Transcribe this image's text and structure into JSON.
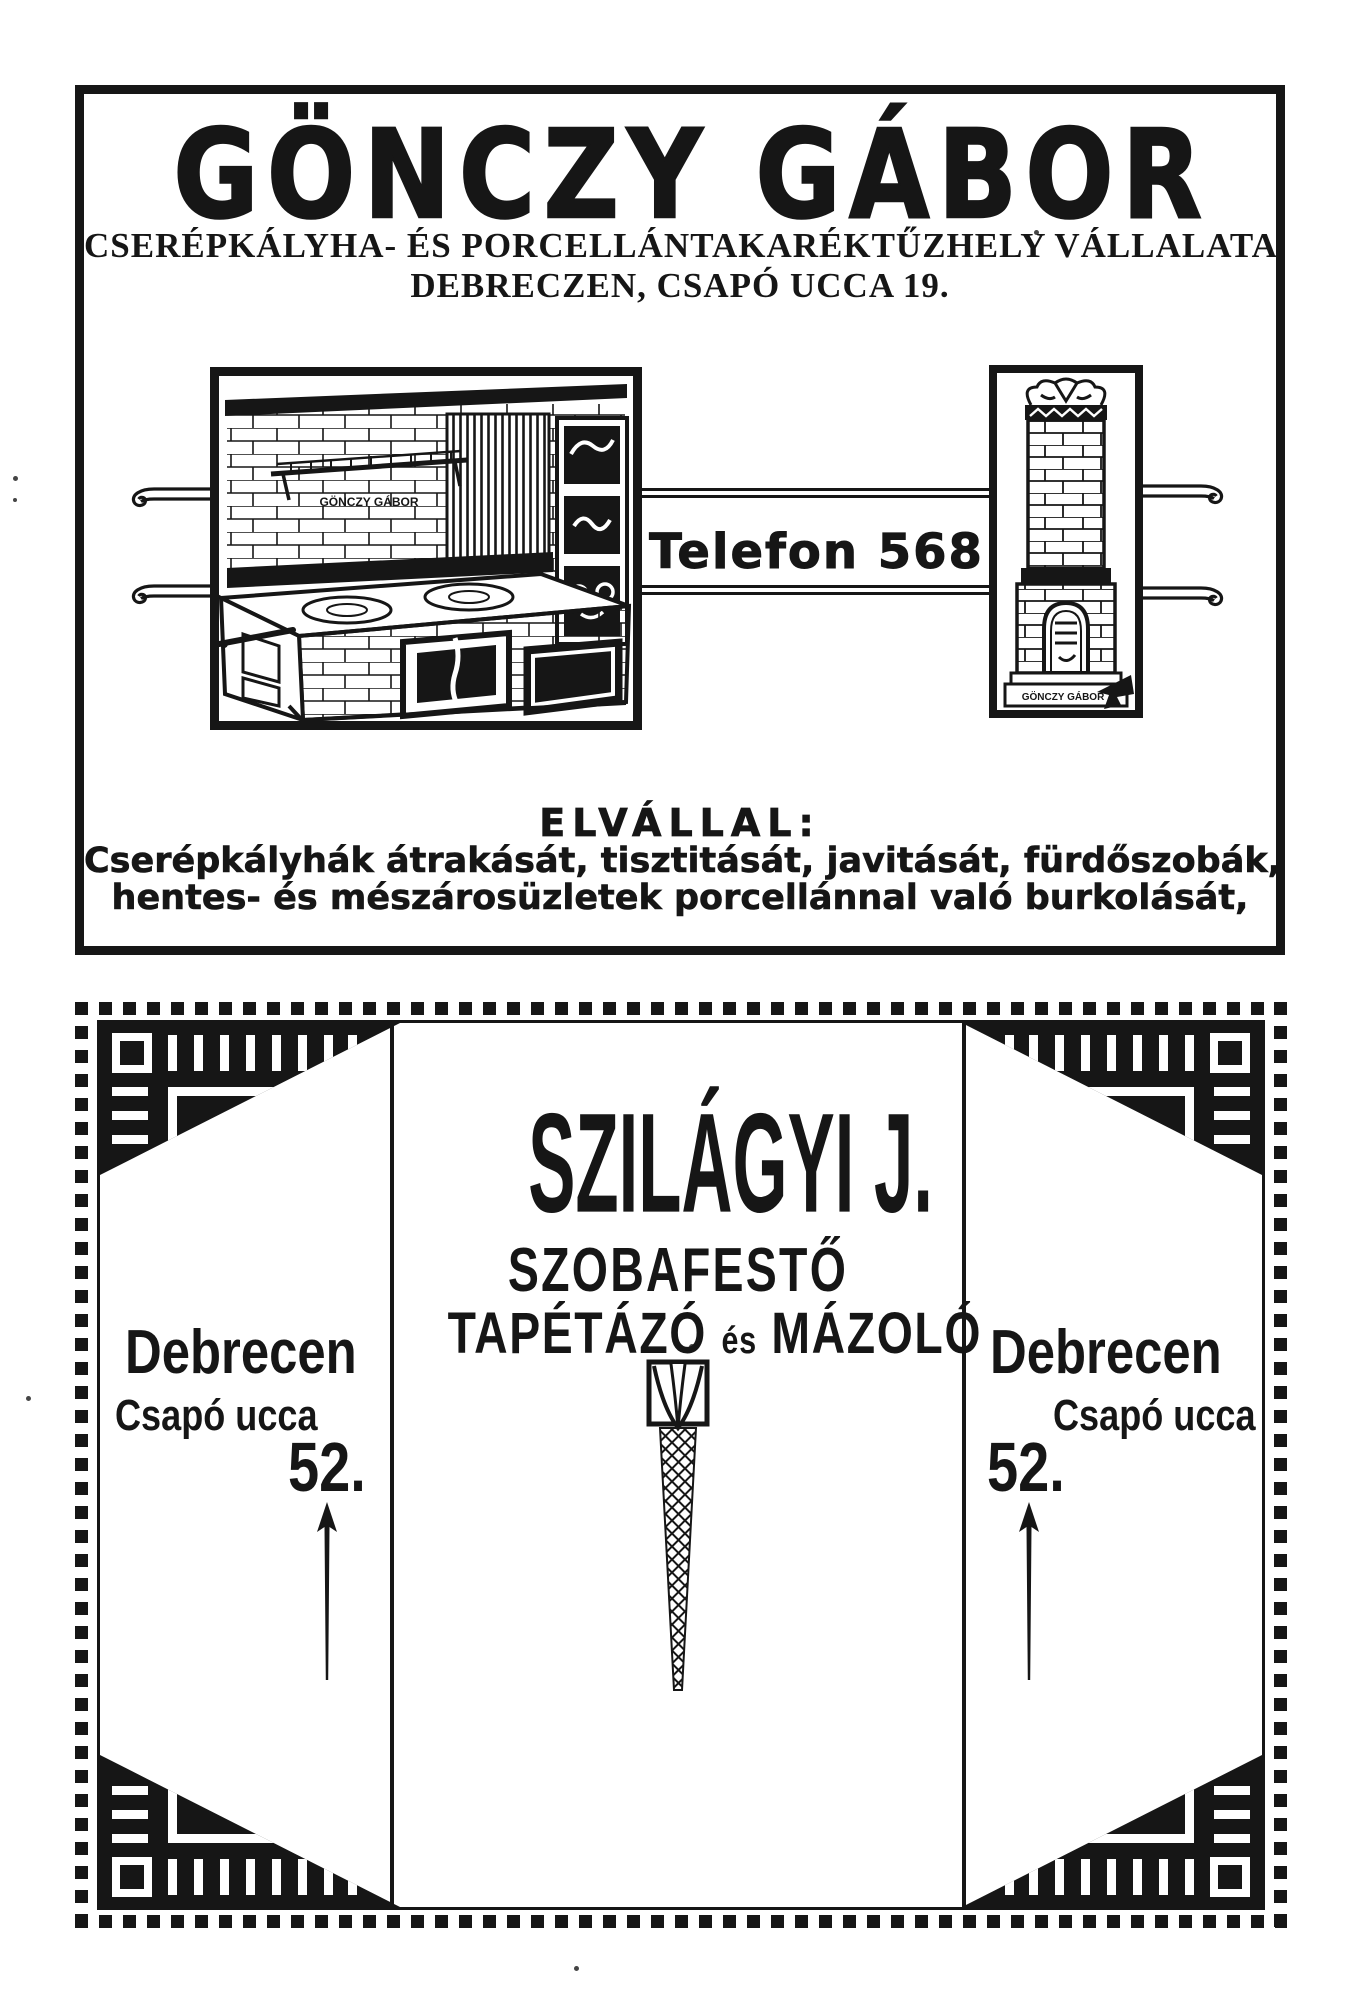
{
  "page": {
    "background": "#ffffff",
    "ink": "#161616"
  },
  "gonczy_ad": {
    "title": "GÖNCZY GÁBOR",
    "subtitle": "CSERÉPKÁLYHA- ÉS PORCELLÁNTAKARÉKTŰZHELY VÁLLALATA",
    "address_line": "DEBRECZEN, CSAPÓ UCCA 19.",
    "telephone": "Telefon 568",
    "range_plate_label": "GÖNCZY GÁBOR",
    "stove_base_label": "GÖNCZY GÁBOR",
    "services_heading": "ELVÁLLAL:",
    "services_line1": "Cserépkályhák átrakását, tisztitását, javitását, fürdőszobák,",
    "services_line2": "hentes- és mészárosüzletek porcellánnal való burkolását,"
  },
  "szilagyi_ad": {
    "name": "SZILÁGYI J.",
    "trade_line1": "SZOBAFESTŐ",
    "trade_line2_a": "TAPÉTÁZÓ",
    "trade_line2_conj": "és",
    "trade_line2_b": "MÁZOLÓ",
    "left_address": {
      "city": "Debrecen",
      "street": "Csapó ucca",
      "house_number": "52."
    },
    "right_address": {
      "city": "Debrecen",
      "street": "Csapó ucca",
      "house_number": "52."
    }
  }
}
